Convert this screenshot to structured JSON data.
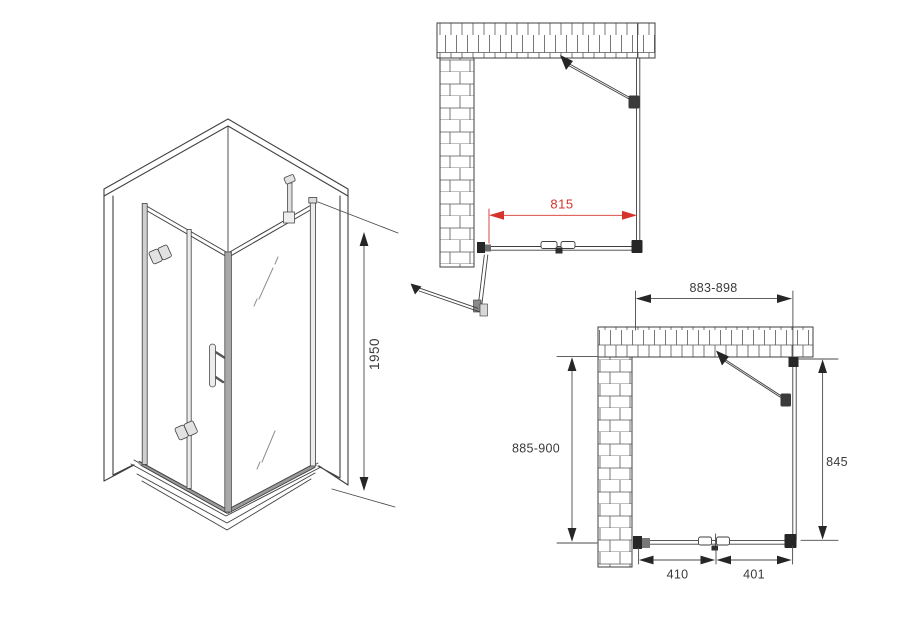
{
  "drawing": {
    "title": "shower-enclosure-technical-drawing"
  },
  "colors": {
    "line": "#3f3f3f",
    "thin_line": "#6b6b6b",
    "dimension_red": "#d5342c",
    "dimension_text": "#3a3a3a",
    "bracket_dark": "#262626"
  },
  "views": {
    "isometric": {
      "height": "1950"
    },
    "top_plan": {
      "panel_width": "815"
    },
    "side_plan": {
      "overall_width": "883-898",
      "overall_depth": "885-900",
      "inner_depth": "845",
      "door_segment_left": "410",
      "door_segment_right": "401"
    }
  }
}
